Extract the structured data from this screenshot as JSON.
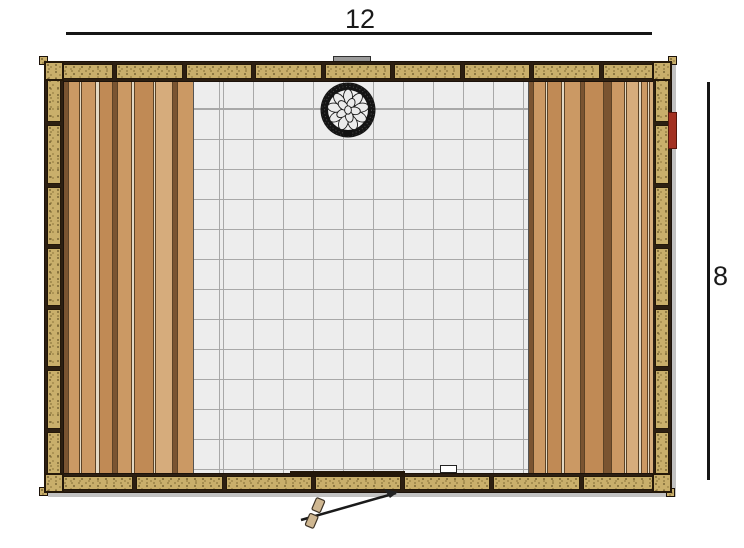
{
  "figure": {
    "type": "floor-plan",
    "subject": "sauna-top-view"
  },
  "dimensions": {
    "width_label": "12",
    "height_label": "8"
  },
  "colors": {
    "dimension_line": "#161616",
    "wall_trim": "#241809",
    "wall_panel": "#c9af6b",
    "tile": "#ededed",
    "tile_grid": "#a8a8a8",
    "heater_ring": "#141414",
    "heater_stone": "#ebebeb",
    "door_latch_red": "#a33122",
    "vent_gray": "#9b9b9b",
    "drain_white": "#ffffff"
  },
  "walls": {
    "top_segments": 9,
    "bottom_segments": 7,
    "left_segments": 7,
    "right_segments": 7
  },
  "benches": {
    "tones": [
      "#c08a55",
      "#cb9964",
      "#d6ac7c",
      "#7a5431",
      "#e3d9c4"
    ],
    "left": [
      {
        "w": 4,
        "t": 3
      },
      {
        "w": 11,
        "t": 1
      },
      {
        "w": 2,
        "t": 4
      },
      {
        "w": 14,
        "t": 1
      },
      {
        "w": 3,
        "t": 4
      },
      {
        "w": 13,
        "t": 0
      },
      {
        "w": 5,
        "t": 3
      },
      {
        "w": 14,
        "t": 1
      },
      {
        "w": 3,
        "t": 4
      },
      {
        "w": 19,
        "t": 0
      },
      {
        "w": 2,
        "t": 4
      },
      {
        "w": 16,
        "t": 2
      },
      {
        "w": 5,
        "t": 3
      },
      {
        "w": 16,
        "t": 1
      }
    ],
    "right": [
      {
        "w": 4,
        "t": 3
      },
      {
        "w": 12,
        "t": 1
      },
      {
        "w": 2,
        "t": 4
      },
      {
        "w": 14,
        "t": 0
      },
      {
        "w": 3,
        "t": 4
      },
      {
        "w": 16,
        "t": 1
      },
      {
        "w": 4,
        "t": 3
      },
      {
        "w": 18,
        "t": 0
      },
      {
        "w": 8,
        "t": 3
      },
      {
        "w": 13,
        "t": 1
      },
      {
        "w": 2,
        "t": 4
      },
      {
        "w": 12,
        "t": 2
      },
      {
        "w": 3,
        "t": 4
      },
      {
        "w": 6,
        "t": 1
      },
      {
        "w": 2,
        "t": 4
      },
      {
        "w": 4,
        "t": 2
      }
    ]
  },
  "heater": {
    "outer_stones": 9,
    "inner_stones": 5
  },
  "tile": {
    "size": 30
  }
}
